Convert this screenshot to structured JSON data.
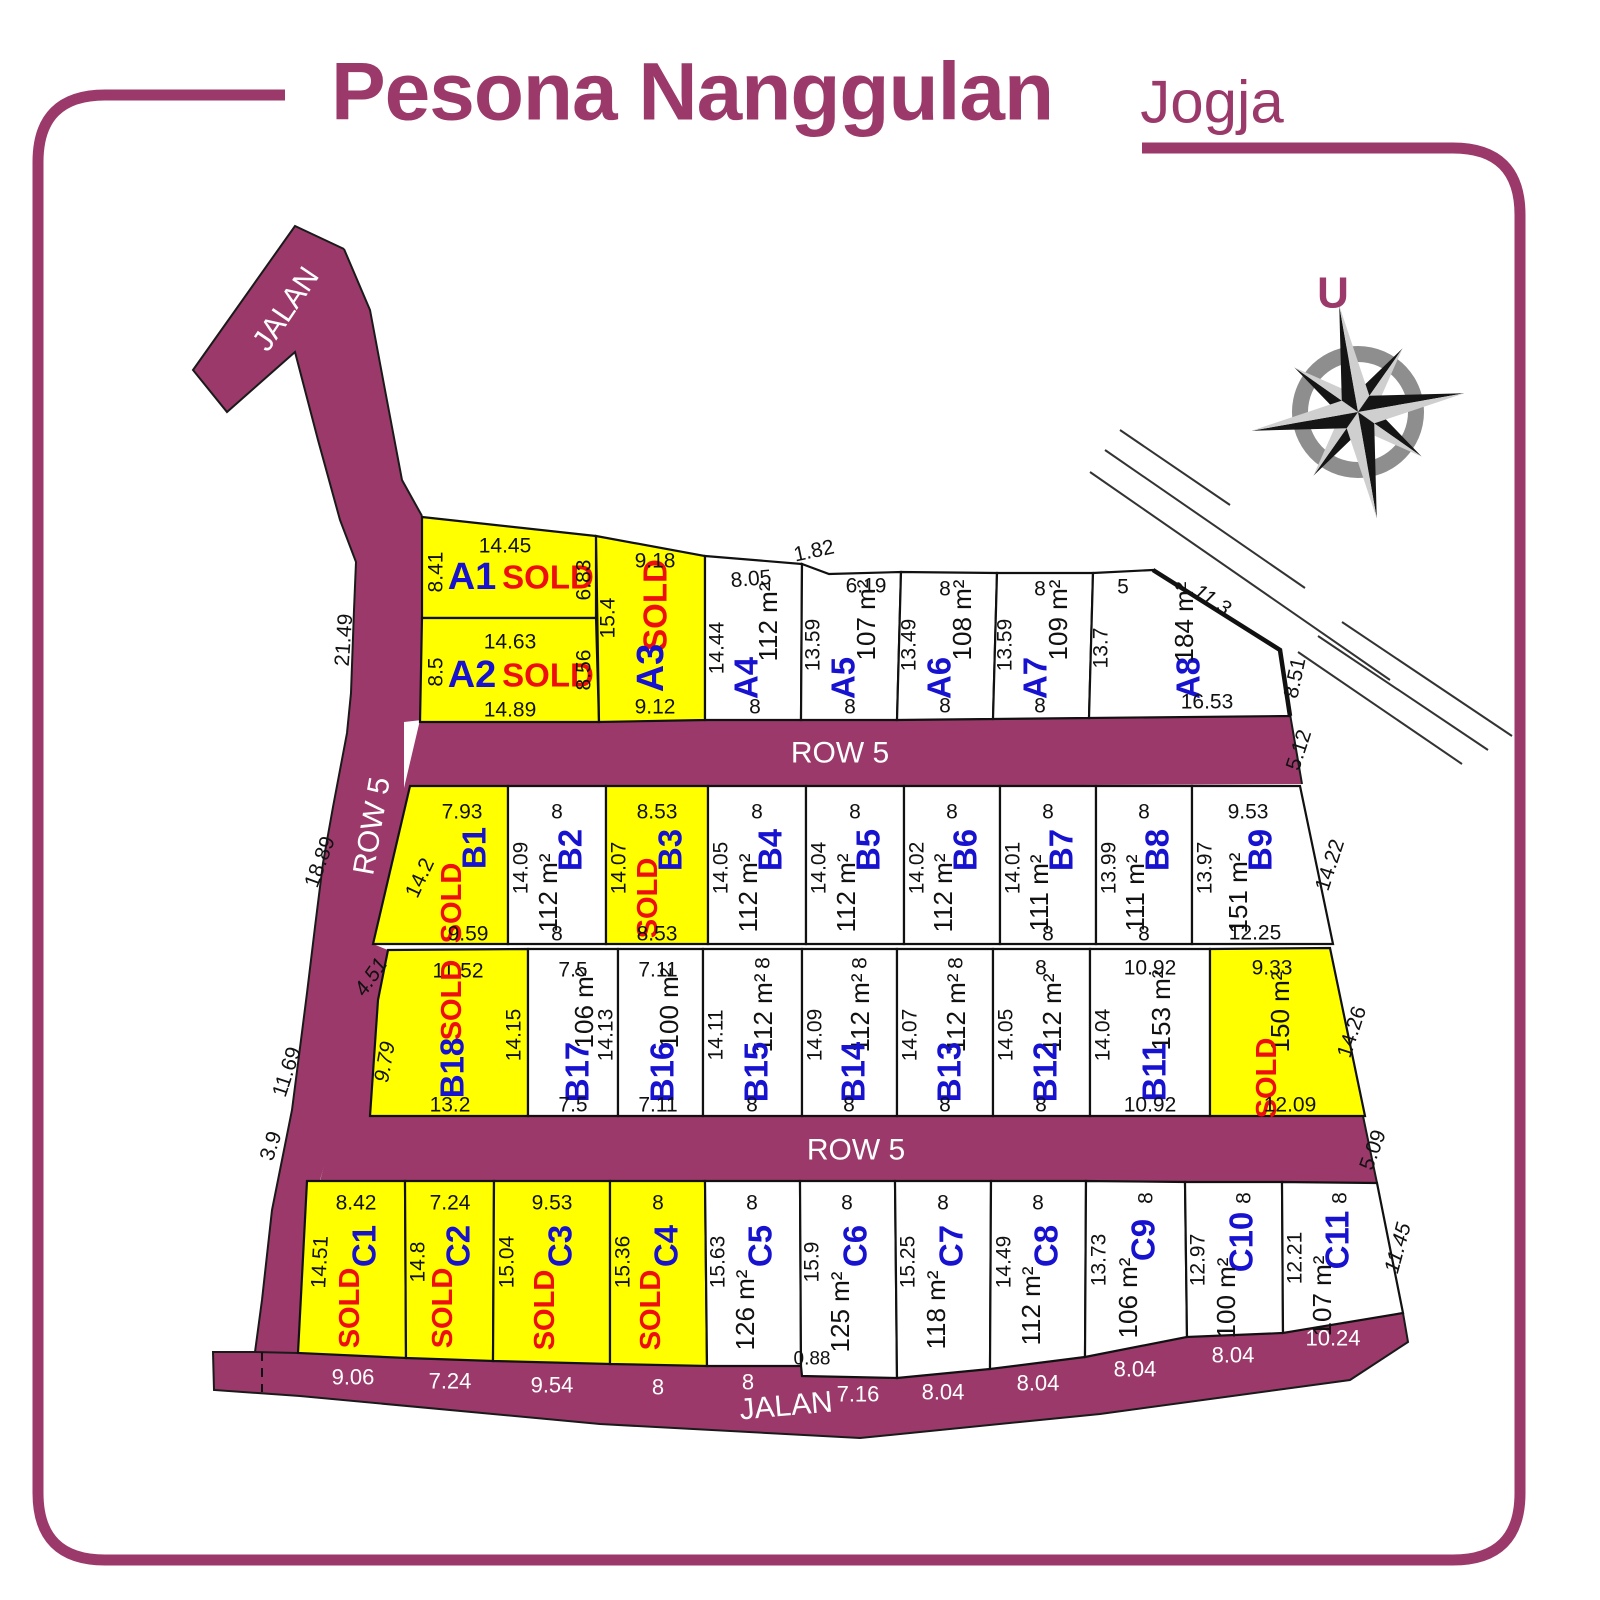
{
  "title": {
    "main": "Pesona Nanggulan",
    "sub": "Jogja"
  },
  "compass": {
    "north": "U"
  },
  "roads": {
    "jalan_top": "JALAN",
    "row5_left": "ROW 5",
    "row5_upper": "ROW 5",
    "row5_lower": "ROW 5",
    "jalan_bottom": "JALAN"
  },
  "boundary": {
    "left_dims": [
      "21.49",
      "18.89",
      "11.69",
      "3.9"
    ],
    "notch": "1.82",
    "row5_upper_end": "5.12",
    "row5_lower_end": "5.09"
  },
  "colors": {
    "road": "#9b3a6a",
    "frame": "#9b3a6a",
    "sold_fill": "#ffff00",
    "available_fill": "#ffffff",
    "plot_id_text": "#1712cf",
    "sold_text": "#ee0e0e",
    "dim_text": "#111111",
    "road_dim_text": "#ffffff"
  },
  "blocks": {
    "A": [
      {
        "id": "A1",
        "status": "SOLD",
        "top": "14.45",
        "left": "8.41",
        "right": "6.83"
      },
      {
        "id": "A2",
        "status": "SOLD",
        "top": "14.63",
        "left": "8.5",
        "right": "8.56",
        "bottom": "14.89"
      },
      {
        "id": "A3",
        "status": "SOLD",
        "top": "9.18",
        "left": "15.4",
        "bottom": "9.12"
      },
      {
        "id": "A4",
        "area": "112 m²",
        "top": "8.05",
        "left": "14.44",
        "bottom": "8"
      },
      {
        "id": "A5",
        "area": "107 m²",
        "top": "6.19",
        "left": "13.59",
        "bottom": "8"
      },
      {
        "id": "A6",
        "area": "108 m²",
        "top": "8",
        "left": "13.49",
        "bottom": "8"
      },
      {
        "id": "A7",
        "area": "109 m²",
        "top": "8",
        "left": "13.59",
        "bottom": "8"
      },
      {
        "id": "A8",
        "area": "184 m²",
        "top": "5",
        "left": "13.7",
        "bottom": "16.53",
        "diag": "11.3",
        "right": "8.51"
      }
    ],
    "B_upper": [
      {
        "id": "B1",
        "status": "SOLD",
        "top": "7.93",
        "left": "14.2",
        "bottom": "9.59"
      },
      {
        "id": "B2",
        "area": "112 m²",
        "top": "8",
        "left": "14.09",
        "bottom": "8"
      },
      {
        "id": "B3",
        "status": "SOLD",
        "top": "8.53",
        "left": "14.07",
        "bottom": "8.53"
      },
      {
        "id": "B4",
        "area": "112 m²",
        "top": "8",
        "left": "14.05"
      },
      {
        "id": "B5",
        "area": "112 m²",
        "top": "8",
        "left": "14.04"
      },
      {
        "id": "B6",
        "area": "112 m²",
        "top": "8",
        "left": "14.02"
      },
      {
        "id": "B7",
        "area": "111 m²",
        "top": "8",
        "left": "14.01",
        "bottom": "8"
      },
      {
        "id": "B8",
        "area": "111 m²",
        "top": "8",
        "left": "13.99",
        "bottom": "8"
      },
      {
        "id": "B9",
        "area": "151 m²",
        "top": "9.53",
        "left": "13.97",
        "bottom": "12.25",
        "right": "14.22"
      }
    ],
    "B_lower": [
      {
        "id": "B18",
        "status": "SOLD",
        "top": "11.52",
        "diag": "4.51",
        "left": "9.79",
        "right": "14.15",
        "bottom": "13.2"
      },
      {
        "id": "B17",
        "area": "106 m²",
        "top": "7.5",
        "right": "14.13",
        "bottom": "7.5"
      },
      {
        "id": "B16",
        "area": "100 m²",
        "top": "7.11",
        "bottom": "7.11"
      },
      {
        "id": "B15",
        "area": "112 m²",
        "top": "8",
        "left": "14.11",
        "bottom": "8"
      },
      {
        "id": "B14",
        "area": "112 m²",
        "top": "8",
        "left": "14.09",
        "bottom": "8"
      },
      {
        "id": "B13",
        "area": "112 m²",
        "top": "8",
        "left": "14.07",
        "bottom": "8"
      },
      {
        "id": "B12",
        "area": "112 m²",
        "top": "8",
        "left": "14.05",
        "bottom": "8"
      },
      {
        "id": "B11",
        "area": "153 m²",
        "top": "10.92",
        "left": "14.04",
        "bottom": "10.92"
      },
      {
        "id": "",
        "status": "SOLD",
        "area": "150 m²",
        "top": "9.33",
        "right": "14.26",
        "bottom": "12.09"
      }
    ],
    "C": [
      {
        "id": "C1",
        "status": "SOLD",
        "top": "8.42",
        "left": "14.51",
        "bottom": "9.06"
      },
      {
        "id": "C2",
        "status": "SOLD",
        "top": "7.24",
        "left": "14.8",
        "bottom": "7.24"
      },
      {
        "id": "C3",
        "status": "SOLD",
        "top": "9.53",
        "left": "15.04",
        "bottom": "9.54"
      },
      {
        "id": "C4",
        "status": "SOLD",
        "top": "8",
        "left": "15.36",
        "bottom": "8"
      },
      {
        "id": "C5",
        "area": "126 m²",
        "top": "8",
        "left": "15.63",
        "bottom": "8",
        "step": "0.88"
      },
      {
        "id": "C6",
        "area": "125 m²",
        "top": "8",
        "left": "15.9",
        "bottom": "7.16"
      },
      {
        "id": "C7",
        "area": "118 m²",
        "top": "8",
        "left": "15.25",
        "bottom": "8.04"
      },
      {
        "id": "C8",
        "area": "112 m²",
        "top": "8",
        "left": "14.49",
        "bottom": "8.04"
      },
      {
        "id": "C9",
        "area": "106 m²",
        "top": "8",
        "left": "13.73",
        "bottom": "8.04"
      },
      {
        "id": "C10",
        "area": "100 m²",
        "top": "8",
        "left": "12.97",
        "bottom": "8.04"
      },
      {
        "id": "C11",
        "area": "107 m²",
        "top": "8",
        "left": "12.21",
        "bottom": "10.24",
        "right": "11.45"
      }
    ]
  }
}
